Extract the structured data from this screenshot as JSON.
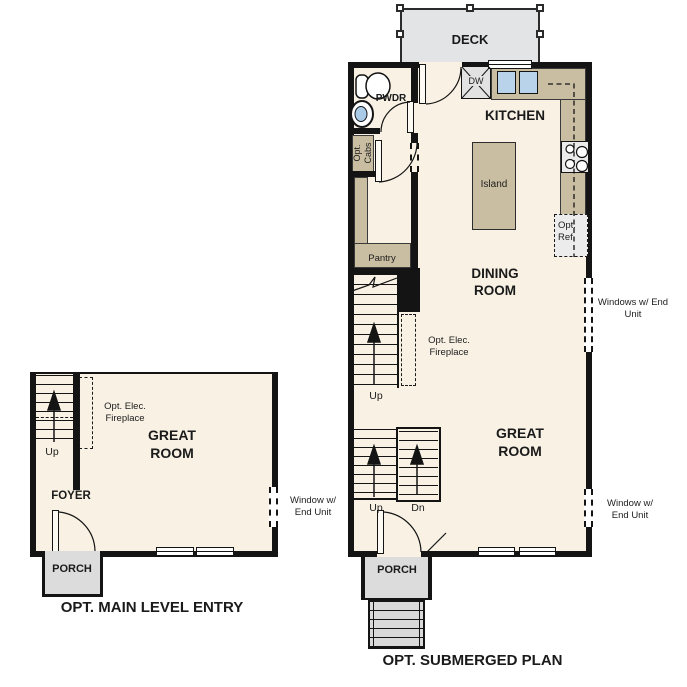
{
  "left_plan": {
    "title": "OPT. MAIN LEVEL ENTRY",
    "great_room": "GREAT ROOM",
    "foyer": "FOYER",
    "porch": "PORCH",
    "up": "Up",
    "fireplace_note": "Opt. Elec. Fireplace",
    "window_note": "Window w/ End Unit"
  },
  "right_plan": {
    "title": "OPT. SUBMERGED PLAN",
    "deck": "DECK",
    "pwdr": "PWDR",
    "kitchen": "KITCHEN",
    "dining_room": "DINING ROOM",
    "great_room": "GREAT ROOM",
    "porch": "PORCH",
    "island": "Island",
    "pantry": "Pantry",
    "dw": "DW",
    "opt_cabs": "Opt. Cabs",
    "opt_ref": "Opt. Ref",
    "fireplace_note": "Opt. Elec. Fireplace",
    "windows_note": "Windows w/ End Unit",
    "window_note": "Window w/ End Unit",
    "up_main": "Up",
    "up_entry": "Up",
    "dn_entry": "Dn"
  },
  "colors": {
    "floor": "#f8f1e4",
    "wall": "#141414",
    "counter": "#cabea2",
    "deck": "#e3e4e5",
    "porch": "#dcdcdc",
    "sink": "#b9d3ea",
    "appliance": "#e9e9e9"
  }
}
